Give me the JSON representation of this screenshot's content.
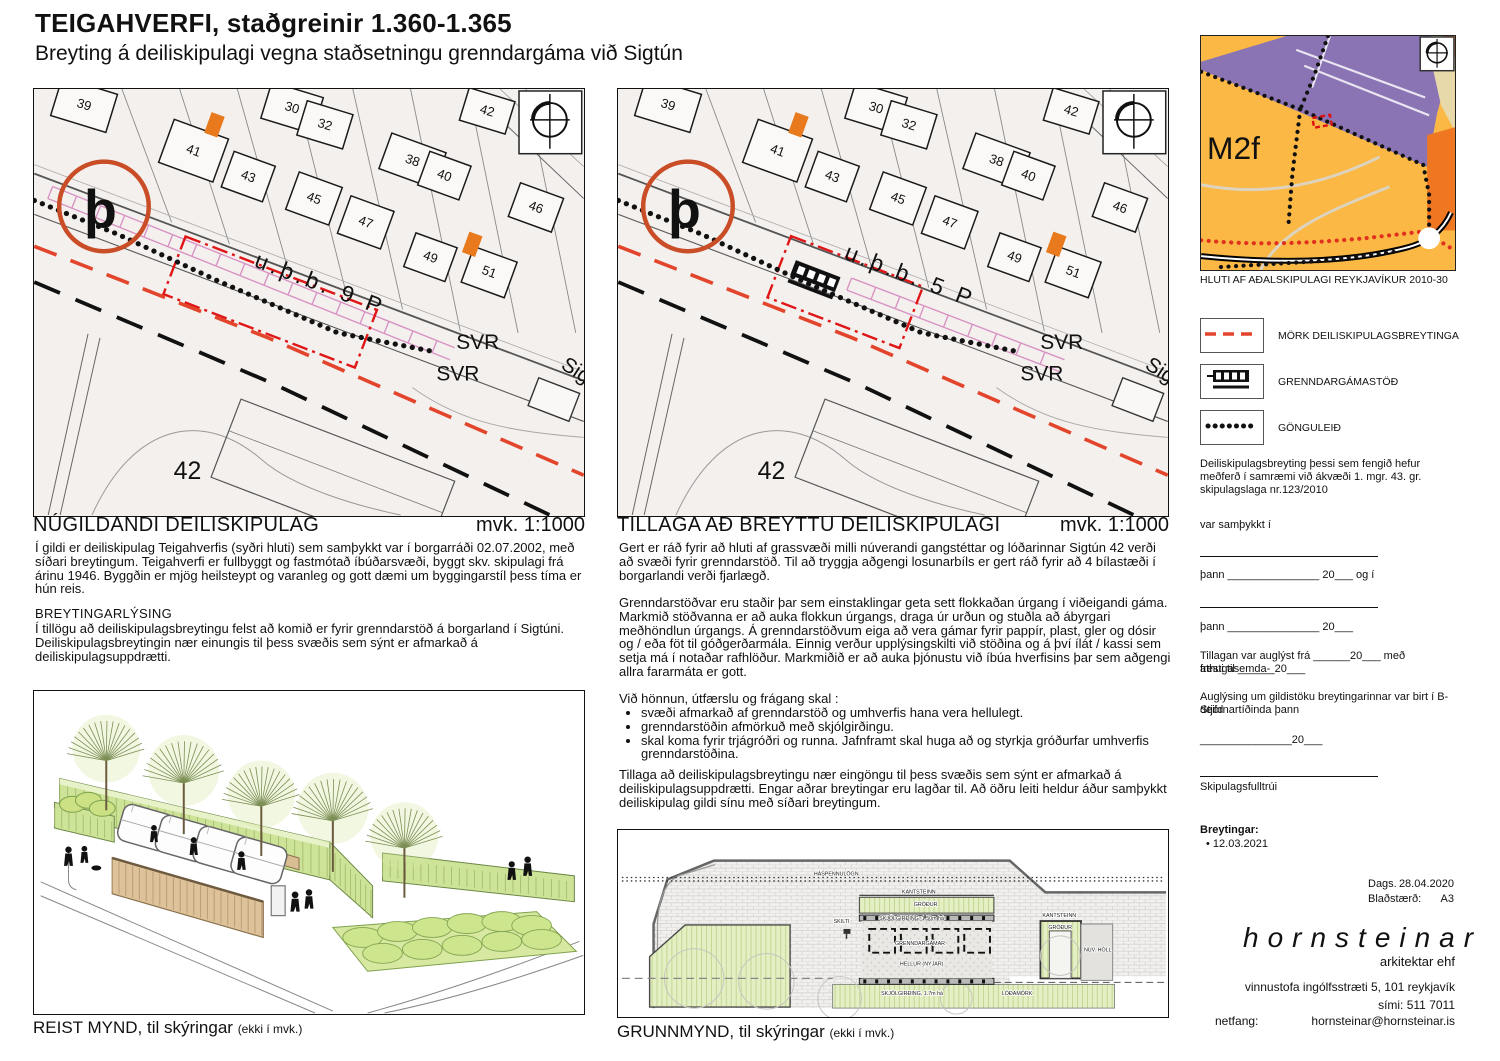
{
  "title": "TEIGAHVERFI, staðgreinir 1.360-1.365",
  "subtitle": "Breyting á deiliskipulagi vegna staðsetningu grenndargáma við Sigtún",
  "maps": {
    "base": {
      "houses": [
        {
          "n": "39",
          "x": 50,
          "y": 16,
          "r": 17,
          "w": 58,
          "h": 40
        },
        {
          "n": "30",
          "x": 259,
          "y": 19,
          "r": 17,
          "w": 54,
          "h": 38
        },
        {
          "n": "32",
          "x": 292,
          "y": 36,
          "r": 17,
          "w": 48,
          "h": 36
        },
        {
          "n": "41",
          "x": 160,
          "y": 62,
          "r": 20,
          "w": 58,
          "h": 46
        },
        {
          "n": "43",
          "x": 215,
          "y": 88,
          "r": 20,
          "w": 44,
          "h": 38
        },
        {
          "n": "45",
          "x": 281,
          "y": 110,
          "r": 20,
          "w": 46,
          "h": 40
        },
        {
          "n": "47",
          "x": 333,
          "y": 134,
          "r": 20,
          "w": 46,
          "h": 40
        },
        {
          "n": "38",
          "x": 380,
          "y": 72,
          "r": 20,
          "w": 58,
          "h": 38
        },
        {
          "n": "40",
          "x": 412,
          "y": 87,
          "r": 20,
          "w": 44,
          "h": 36
        },
        {
          "n": "42",
          "x": 455,
          "y": 22,
          "r": 17,
          "w": 48,
          "h": 34
        },
        {
          "n": "46",
          "x": 504,
          "y": 119,
          "r": 20,
          "w": 46,
          "h": 36
        },
        {
          "n": "49",
          "x": 398,
          "y": 169,
          "r": 20,
          "w": 44,
          "h": 36
        },
        {
          "n": "51",
          "x": 457,
          "y": 184,
          "r": 20,
          "w": 46,
          "h": 38
        }
      ],
      "labels": [
        {
          "t": "þ",
          "x": 50,
          "y": 139,
          "s": 54,
          "b": 1
        },
        {
          "t": "SVR",
          "x": 424,
          "y": 261,
          "s": 21
        },
        {
          "t": "SVR",
          "x": 404,
          "y": 293,
          "s": 21
        },
        {
          "t": "Sig",
          "x": 528,
          "y": 280,
          "s": 21,
          "r": 33
        },
        {
          "t": "42",
          "x": 140,
          "y": 392,
          "s": 25
        }
      ]
    },
    "left": {
      "heading": "NÚGILDANDI DEILISKIPULAG",
      "scale": "mvk. 1:1000",
      "parking": {
        "t": "u.þ.b. 9 P",
        "x": 220,
        "y": 178
      },
      "rect": {
        "x": 237,
        "y": 214,
        "w": 206,
        "h": 62
      },
      "pink": [
        16,
        104,
        420,
        266
      ],
      "station": 0
    },
    "right": {
      "heading": "TILLAGA AÐ BREYTTU DEILISKIPULAGI",
      "scale": "mvk. 1:1000",
      "parking": {
        "t": "u.þ.b. 5 P",
        "x": 226,
        "y": 170
      },
      "rect": {
        "x": 228,
        "y": 204,
        "w": 142,
        "h": 66
      },
      "pink": [
        232,
        196,
        446,
        278
      ],
      "station": 1,
      "station_pos": {
        "x": 198,
        "y": 188
      }
    }
  },
  "texts": {
    "current_plan": "Í gildi er deiliskipulag Teigahverfis (syðri hluti) sem samþykkt var í borgarráði 02.07.2002, með síðari breytingum. Teigahverfi er fullbyggt og fastmótað íbúðarsvæði, byggt skv. skipulagi frá árinu 1946. Byggðin er mjög heilsteypt og varanleg og gott dæmi um byggingarstíl þess tíma er hún reis.",
    "breytingarlysing_heading": "BREYTINGARLÝSING",
    "breytingarlysing": "Í tillögu að deiliskipulagsbreytingu felst að komið er fyrir grenndarstöð á borgarland í Sigtúni. Deiliskipulagsbreytingin nær einungis til þess svæðis sem sýnt er afmarkað á deiliskipulagsuppdrætti.",
    "proposal_p1": "Gert er ráð fyrir að hluti af grassvæði milli núverandi gangstéttar og lóðarinnar Sigtún 42 verði að svæði fyrir grenndarstöð. Til að tryggja aðgengi losunarbíls er gert ráð fyrir að 4 bílastæði í borgarlandi verði fjarlægð.",
    "proposal_p2": "Grenndarstöðvar eru staðir þar sem einstaklingar geta sett flokkaðan úrgang í viðeigandi gáma. Markmið stöðvanna er að auka flokkun úrgangs, draga úr urðun og stuðla að ábyrgari meðhöndlun úrgangs. Á grenndarstöðvum eiga að vera gámar fyrir pappír, plast, gler og dósir og / eða föt til góðgerðarmála. Einnig verður upplýsingskilti við stöðina og á því ílát / kassi sem setja má í notaðar rafhlöður. Markmiðið er að auka þjónustu við íbúa hverfisins þar sem aðgengi allra fararmáta er gott.",
    "design_intro": "Við hönnun, útfærslu og frágang skal :",
    "design_bullets": [
      "svæði afmarkað af grenndarstöð og umhverfis hana vera hellulegt.",
      "grenndarstöðin afmörkuð með skjólgirðingu.",
      "skal koma fyrir trjágróðri og runna. Jafnframt skal huga að og styrkja gróðurfar umhverfis grenndarstöðina."
    ],
    "proposal_p3": "Tillaga að deiliskipulagsbreytingu nær eingöngu til þess svæðis sem sýnt er afmarkað á deiliskipulagsuppdrætti. Engar aðrar breytingar eru lagðar til.  Að öðru leiti heldur áður samþykkt deiliskipulag gildi sínu með síðari breytingum."
  },
  "minimap": {
    "area_label": "M2f",
    "caption": "HLUTI AF AÐALSKIPULAGI REYKJAVÍKUR 2010-30",
    "colors": {
      "amber": "#fbb844",
      "purple": "#8a74b4",
      "orange": "#ef7722",
      "beige": "#e8d9ab",
      "red": "#e0301e"
    }
  },
  "legend": [
    {
      "symbol": "red-dashed-line",
      "label": "MÖRK DEILISKIPULAGSBREYTINGA"
    },
    {
      "symbol": "container-station",
      "label": "GRENNDARGÁMASTÖÐ"
    },
    {
      "symbol": "dotted-line",
      "label": "GÖNGULEIÐ"
    }
  ],
  "approval": {
    "intro": "Deiliskipulagsbreyting þessi sem fengið hefur meðferð í samræmi við ákvæði  1. mgr. 43. gr. skipulagslaga nr.123/2010",
    "var_samthykkt": "var samþykkt í",
    "thann1": "þann _______________ 20___ og í",
    "thann2": "þann _______________ 20___",
    "auglyst_1": "Tillagan var auglýst frá ______20___ með athugasemda-",
    "auglyst_2": "fresti til ______20___",
    "gildistaka_1": "Auglýsing um gildistöku breytingarinnar var birt í B-deild",
    "gildistaka_2": "Stjórnartíðinda þann",
    "date_line": "_______________20___",
    "signature_label": "Skipulagsfulltrúi",
    "breytingar_heading": "Breytingar:",
    "breytingar_item": "•  12.03.2021"
  },
  "footer": {
    "dags_label": "Dags.",
    "dags_value": "28.04.2020",
    "size_label": "Blaðstærð:",
    "size_value": "A3",
    "firm": "hornsteinar",
    "firm_sub": "arkitektar ehf",
    "address": "vinnustofa ingólfsstræti 5, 101 reykjavík",
    "phone": "sími: 511 7011",
    "email_label": "netfang:",
    "email": "hornsteinar@hornsteinar.is"
  },
  "captions": {
    "reist": "REIST MYND, til skýringar",
    "reist_note": "(ekki í mvk.)",
    "grunn": "GRUNNMYND, til skýringar",
    "grunn_note": "(ekki í mvk.)"
  },
  "grunnmynd_labels": [
    {
      "t": "HÁSPENNULÖGN",
      "x": 196,
      "y": 46
    },
    {
      "t": "KANTSTEINN",
      "x": 285,
      "y": 64
    },
    {
      "t": "GRÓÐUR",
      "x": 297,
      "y": 77
    },
    {
      "t": "SKJÓLGIRÐING, 1.50m há",
      "x": 262,
      "y": 91
    },
    {
      "t": "SKILTI",
      "x": 216,
      "y": 94
    },
    {
      "t": "GRENNDARGÁMAR",
      "x": 278,
      "y": 116
    },
    {
      "t": "HELLUR (NÝJAR)",
      "x": 283,
      "y": 137
    },
    {
      "t": "SKJÓLGIRÐING, 1.7m há",
      "x": 264,
      "y": 167
    },
    {
      "t": "LÓÐAMÖRK",
      "x": 386,
      "y": 167
    },
    {
      "t": "KANTSTEINN",
      "x": 427,
      "y": 88
    },
    {
      "t": "GRÓÐUR",
      "x": 433,
      "y": 100
    },
    {
      "t": "NÚV. HÓLL",
      "x": 469,
      "y": 123
    }
  ]
}
